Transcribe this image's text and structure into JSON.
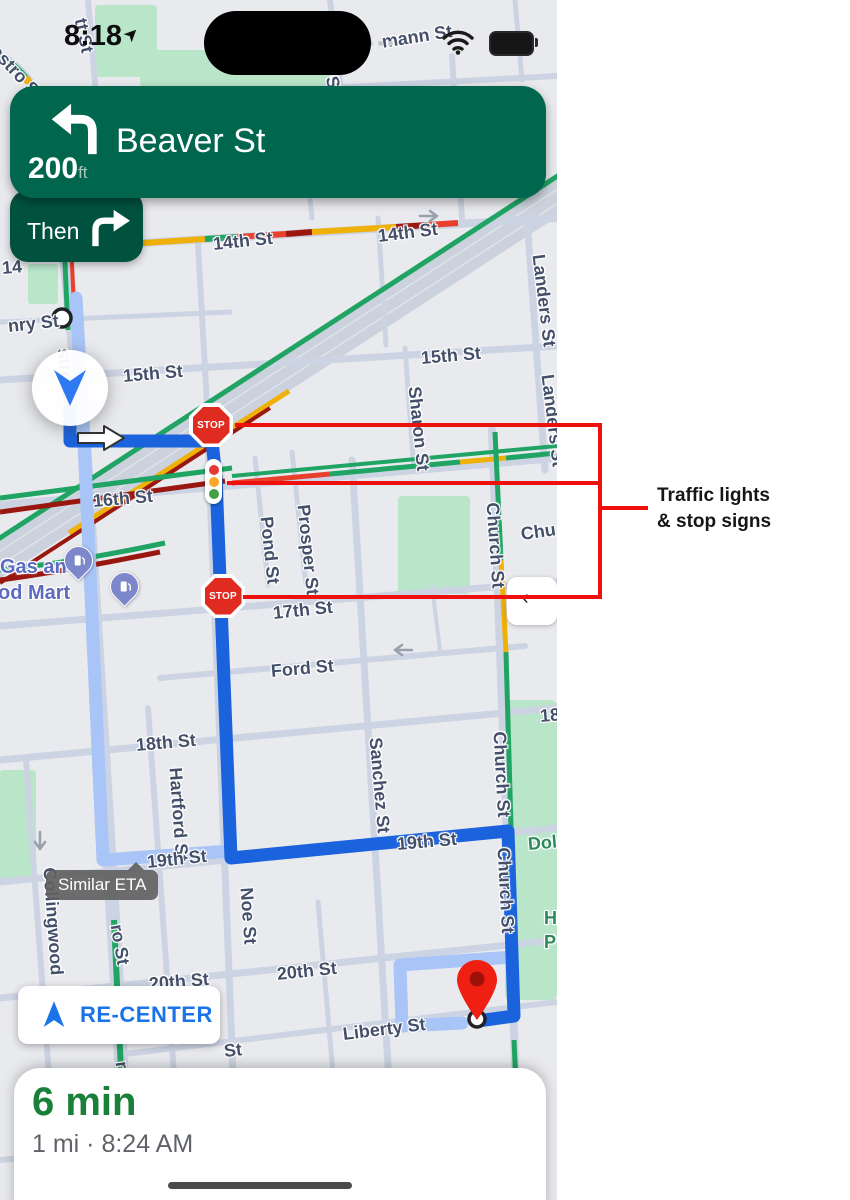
{
  "status_bar": {
    "time": "8:18"
  },
  "nav_banner": {
    "distance": "200",
    "distance_unit": "ft",
    "street": "Beaver St",
    "then_label": "Then"
  },
  "map": {
    "stop_sign_text": "STOP",
    "similar_eta": "Similar ETA",
    "street_labels": [
      "tt St",
      "astro S",
      "S",
      "St",
      "mann St",
      "14",
      "14th St",
      "14th St",
      "Landers St",
      "Landers St",
      "15th St",
      "15th St",
      "Sharon St",
      "nry St",
      "stro St",
      "16th St",
      "Pond St",
      "Prosper St",
      "Church St",
      "Chu",
      "17th St",
      "Ford St",
      "18th St",
      "18",
      "Hartford St",
      "Sanchez St",
      "19th St",
      "19th St",
      "Collingwood",
      "Noe St",
      "Church St",
      "Church St",
      "ro St",
      "ro",
      "20th St",
      "20th St",
      "Liberty St",
      "St",
      "Dol",
      "H",
      "P",
      "Gas and",
      "od Mart"
    ]
  },
  "recenter": {
    "label": "RE-CENTER"
  },
  "eta_card": {
    "duration": "6 min",
    "details": "1 mi · 8:24 AM"
  },
  "annotation": {
    "line1": "Traffic lights",
    "line2": "& stop signs"
  },
  "colors": {
    "banner_green": "#00664d",
    "then_green": "#00523e",
    "route_blue": "#1b63dd",
    "alt_route_blue": "#a9c4f7",
    "traffic_green": "#20a463",
    "traffic_yellow": "#efb008",
    "traffic_red": "#e8402d",
    "traffic_darkred": "#9a1710",
    "map_bg": "#e9eaee",
    "road": "#ccd4e3",
    "park_green": "#b9e5c9",
    "annotation_red": "#ee100a",
    "label_slate": "#44506a",
    "poi_blue": "#5e6abf",
    "park_label": "#2b8a57",
    "recenter_blue": "#1a73e8",
    "eta_green": "#188038",
    "pin_red": "#ef2011"
  }
}
